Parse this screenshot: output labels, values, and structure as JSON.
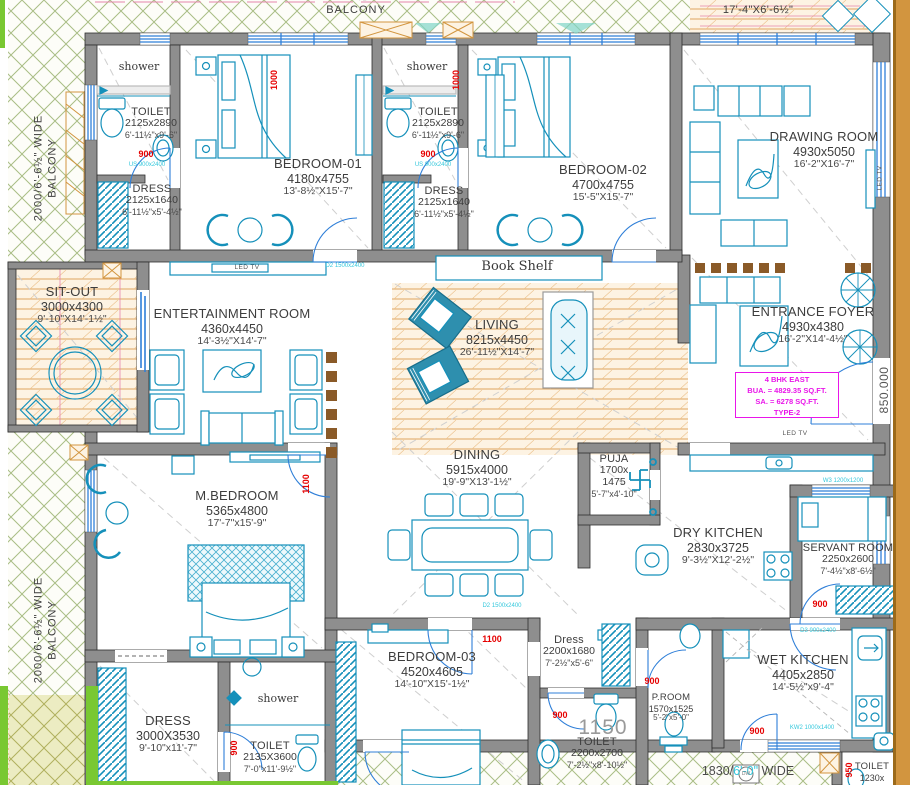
{
  "title": "4 BHK EAST TYPE-2 floor plan",
  "rooms": {
    "toilet1": {
      "name": "TOILET",
      "mm": "2125x2890",
      "ft": "6'-11½\"x9'-6\""
    },
    "dress1": {
      "name": "DRESS",
      "mm": "2125x1640",
      "ft": "6'-11½\"x5'-4½\""
    },
    "bedroom1": {
      "name": "BEDROOM-01",
      "mm": "4180x4755",
      "ft": "13'-8½\"X15'-7\""
    },
    "toilet2": {
      "name": "TOILET",
      "mm": "2125x2890",
      "ft": "6'-11½\"x9'-6\""
    },
    "dress2": {
      "name": "DRESS",
      "mm": "2125x1640",
      "ft": "6'-11½\"x5'-4½\""
    },
    "bedroom2": {
      "name": "BEDROOM-02",
      "mm": "4700x4755",
      "ft": "15'-5\"X15'-7\""
    },
    "drawing": {
      "name": "DRAWING ROOM",
      "mm": "4930x5050",
      "ft": "16'-2\"X16'-7\""
    },
    "sitout": {
      "name": "SIT-OUT",
      "mm": "3000x4300",
      "ft": "9'-10\"X14'-1½\""
    },
    "entertainment": {
      "name": "ENTERTAINMENT ROOM",
      "mm": "4360x4450",
      "ft": "14'-3½\"X14'-7\""
    },
    "living": {
      "name": "LIVING",
      "mm": "8215x4450",
      "ft": "26'-11½\"X14'-7\""
    },
    "foyer": {
      "name": "ENTRANCE FOYER",
      "mm": "4930x4380",
      "ft": "16'-2\"X14'-4½\""
    },
    "dining": {
      "name": "DINING",
      "mm": "5915x4000",
      "ft": "19'-9\"X13'-1½\""
    },
    "puja": {
      "name": "PUJA",
      "mm1": "1700x",
      "mm2": "1475",
      "ft": "5'-7\"x4'-10\""
    },
    "dry_kitchen": {
      "name": "DRY KITCHEN",
      "mm": "2830x3725",
      "ft": "9'-3½\"X12'-2½\""
    },
    "servant": {
      "name": "SERVANT ROOM",
      "mm": "2250x2600",
      "ft": "7'-4½\"x8'-6½\""
    },
    "mbedroom": {
      "name": "M.BEDROOM",
      "mm": "5365x4800",
      "ft": "17'-7\"x15'-9\""
    },
    "bedroom3": {
      "name": "BEDROOM-03",
      "mm": "4520x4605",
      "ft": "14'-10\"X15'-1½\""
    },
    "dress3": {
      "name": "Dress",
      "mm": "2200x1680",
      "ft": "7'-2½\"x5'-6\""
    },
    "toilet3": {
      "name": "TOILET",
      "mm": "2200x2700",
      "ft": "7'-2½\"x8'-10½\""
    },
    "proom": {
      "name": "P.ROOM",
      "mm": "1570x1525",
      "ft": "5'-2\"x5'-0\""
    },
    "wet_kitchen": {
      "name": "WET KITCHEN",
      "mm": "4405x2850",
      "ft": "14'-5½\"x9'-4\""
    },
    "dress_m": {
      "name": "DRESS",
      "mm": "3000X3530",
      "ft": "9'-10\"x11'-7\""
    },
    "toilet_m": {
      "name": "TOILET",
      "mm": "2135X3600",
      "ft": "7'-0\"x11'-9½\""
    },
    "toilet_br": {
      "name": "TOILET",
      "mm": "1230x"
    }
  },
  "info_box": {
    "line1": "4 BHK EAST",
    "line2": "BUA. = 4829.35 SQ.FT.",
    "line3": "SA. = 6278 SQ.FT.",
    "line4": "TYPE-2"
  },
  "labels": {
    "shower": "shower",
    "led_tv": "LED TV",
    "book_shelf": "Book Shelf",
    "balcony_line1": "2000/6'-6½\" WIDE",
    "balcony_line2": "BALCONY",
    "terrace_mm": "5280x2000",
    "terrace_ft": "17'-4\"X6'-6½\"",
    "walkway1": "1830/",
    "walkway2": "6'-0\"",
    "walkway3": " WIDE",
    "level": "850.000",
    "dim_1150": "1150"
  },
  "red_dims": {
    "d1000": "1000",
    "d900": "900",
    "d1100": "1100",
    "d950": "950"
  },
  "tags": {
    "us": "US 900x2400",
    "d2": "D2 1500x2400",
    "w3": "W3 1200x1200",
    "d3": "D3 900x2400",
    "kw2": "KW2 1000x1400",
    "dw": "DW"
  },
  "colors": {
    "wall": "#8e8e8e",
    "furniture": "#1590ba",
    "red": "#e60000",
    "magenta": "#e916e9",
    "hatch_green": "#a9bd85",
    "wood": "#e0a45f",
    "khaki": "#ececc2",
    "tan_strip": "#d2953f",
    "window_blue": "#2f7fd8",
    "cyan_tag": "#35c8dc",
    "accent_green": "#79c832",
    "screen_brown": "#8a5a28"
  }
}
